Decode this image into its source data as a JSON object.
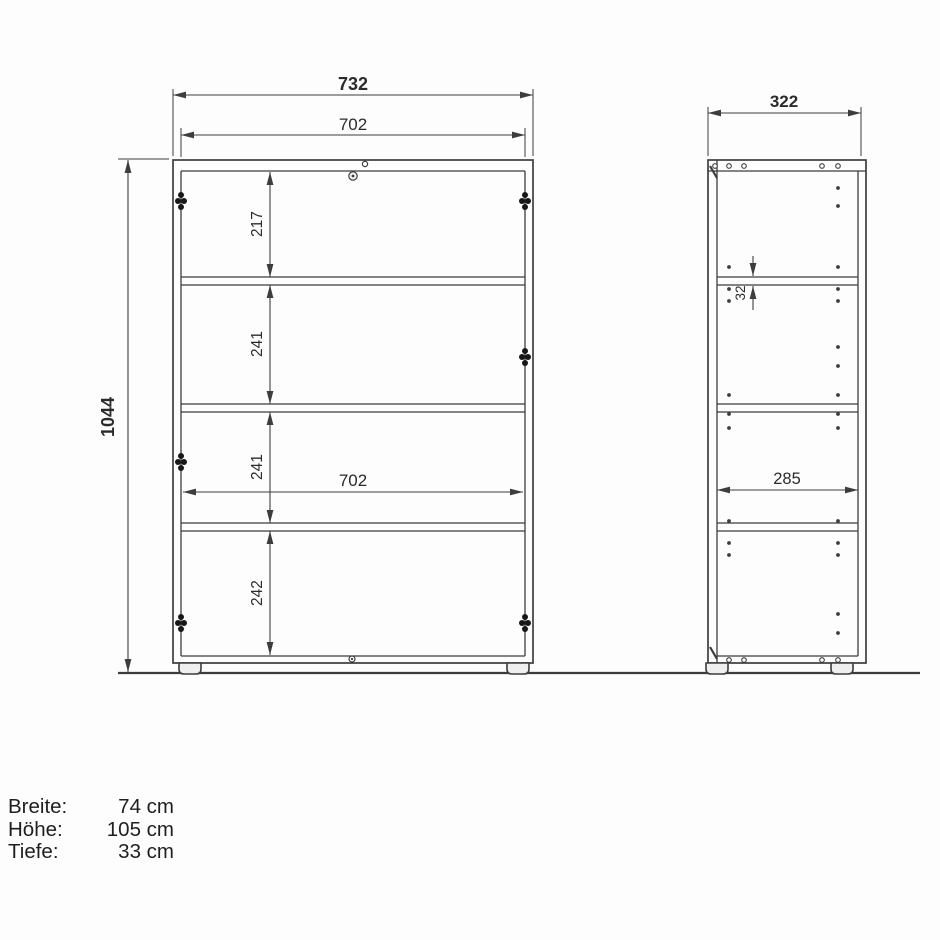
{
  "front_view": {
    "dim_width_outer": "732",
    "dim_width_inner_top": "702",
    "dim_height_total": "1044",
    "dim_section_1": "217",
    "dim_section_2": "241",
    "dim_section_3": "241",
    "dim_section_4": "242",
    "dim_width_inner_mid": "702"
  },
  "side_view": {
    "dim_depth_outer": "322",
    "dim_depth_inner": "285",
    "dim_shelf_thickness": "32"
  },
  "spec": {
    "rows": [
      {
        "label": "Breite:",
        "value": "74 cm"
      },
      {
        "label": "Höhe:",
        "value": "105 cm"
      },
      {
        "label": "Tiefe:",
        "value": "33 cm"
      }
    ]
  },
  "colors": {
    "line": "#3d3d3d",
    "text": "#2b2b2b",
    "background": "#fdfdfd"
  }
}
